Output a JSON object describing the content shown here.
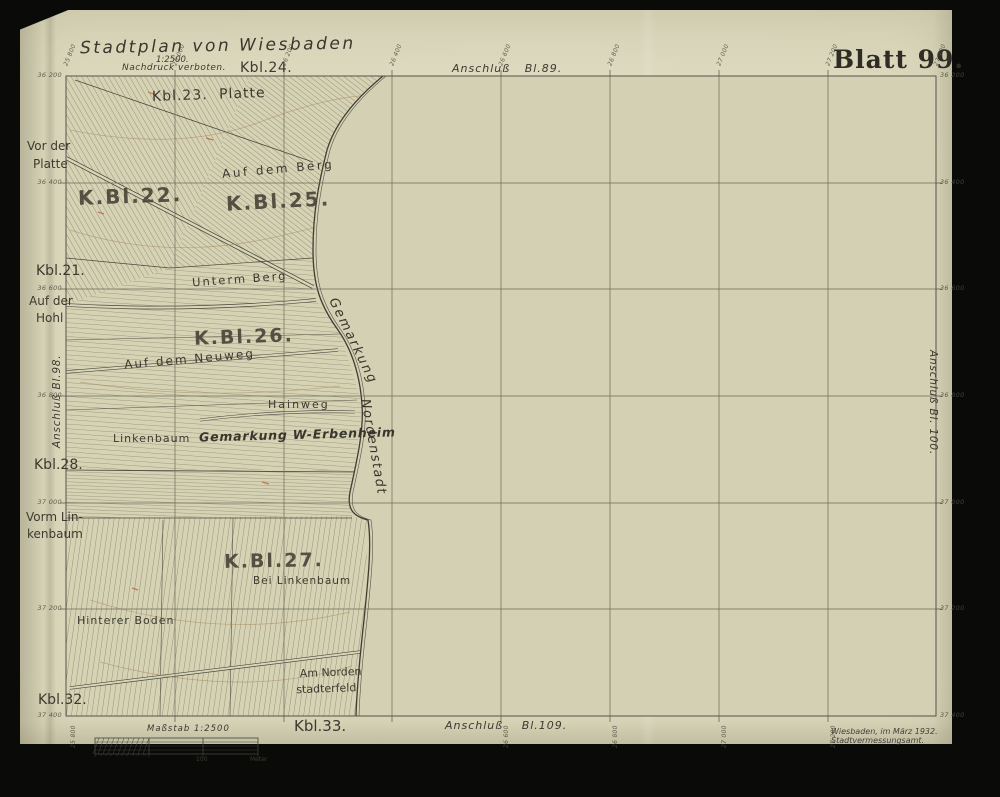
{
  "header": {
    "title": "Stadtplan von Wiesbaden",
    "scale_note": "1:2500.",
    "copyright": "Nachdruck verboten.",
    "sheet_number": "Blatt 99."
  },
  "adjacent": {
    "top": "Anschluß Bl.89.",
    "bottom": "Anschluß Bl.109.",
    "left": "Anschluß Bl.98.",
    "right": "Anschluß Bl. 100.",
    "kbl_top": "Kbl.24.",
    "kbl_bottom": "Kbl.33.",
    "kbl_left_upper": "Kbl.21.",
    "kbl_left_mid": "Kbl.28.",
    "kbl_left_lower": "Kbl.32."
  },
  "margin_names": {
    "vor_der_platte_1": "Vor der",
    "vor_der_platte_2": "Platte",
    "auf_der_hohl_1": "Auf der",
    "auf_der_hohl_2": "Hohl",
    "vorm_linkenbaum_1": "Vorm Lin-",
    "vorm_linkenbaum_2": "kenbaum"
  },
  "map_labels": {
    "kbl23_platte": "Kbl.23.  Platte",
    "block22": "K.Bl.22.",
    "block25": "K.Bl.25.",
    "block26": "K.Bl.26.",
    "block27": "K.Bl.27.",
    "auf_dem_berg": "Auf dem Berg",
    "unterm_berg": "Unterm Berg",
    "auf_dem_neuweg": "Auf dem Neuweg",
    "hainweg": "Hainweg",
    "linkenbaum": "Linkenbaum",
    "gemarkung_erbenheim": "Gemarkung W-Erbenheim",
    "gemarkung_word": "Gemarkung",
    "nordenstadt_word": "Nordenstadt",
    "bei_linkenbaum": "Bei Linkenbaum",
    "hinterer_boden": "Hinterer Boden",
    "am_norden_1": "Am Norden",
    "am_norden_2": "stadterfeld"
  },
  "grid": {
    "left_ticks": [
      "36 200",
      "36 400",
      "36 600",
      "36 800",
      "37 000",
      "37 200",
      "37 400"
    ],
    "right_ticks": [
      "36 200",
      "36 400",
      "36 600",
      "36 800",
      "37 000",
      "37 200",
      "37 400"
    ],
    "top_ticks": [
      "25 800",
      "26 000",
      "26 200",
      "26 400",
      "26 600",
      "26 800",
      "27 000",
      "27 200",
      "27 400"
    ],
    "bottom_ticks": [
      "25 800",
      "26 600",
      "26 800",
      "27 000",
      "27 200"
    ]
  },
  "scalebar": {
    "title": "Maßstab 1:2500",
    "mid_label": "100",
    "unit_label": "Meter"
  },
  "imprint": {
    "line1": "Wiesbaden, im März 1932.",
    "line2": "Stadtvermessungsamt."
  },
  "colors": {
    "paper": "#dbd8bc",
    "map_field": "#d3d0b3",
    "ink": "#3c3a30",
    "grid_line": "#6f6c5c",
    "contour": "#a8835a",
    "red_mark": "#bf5f38",
    "background": "#0a0a08"
  }
}
